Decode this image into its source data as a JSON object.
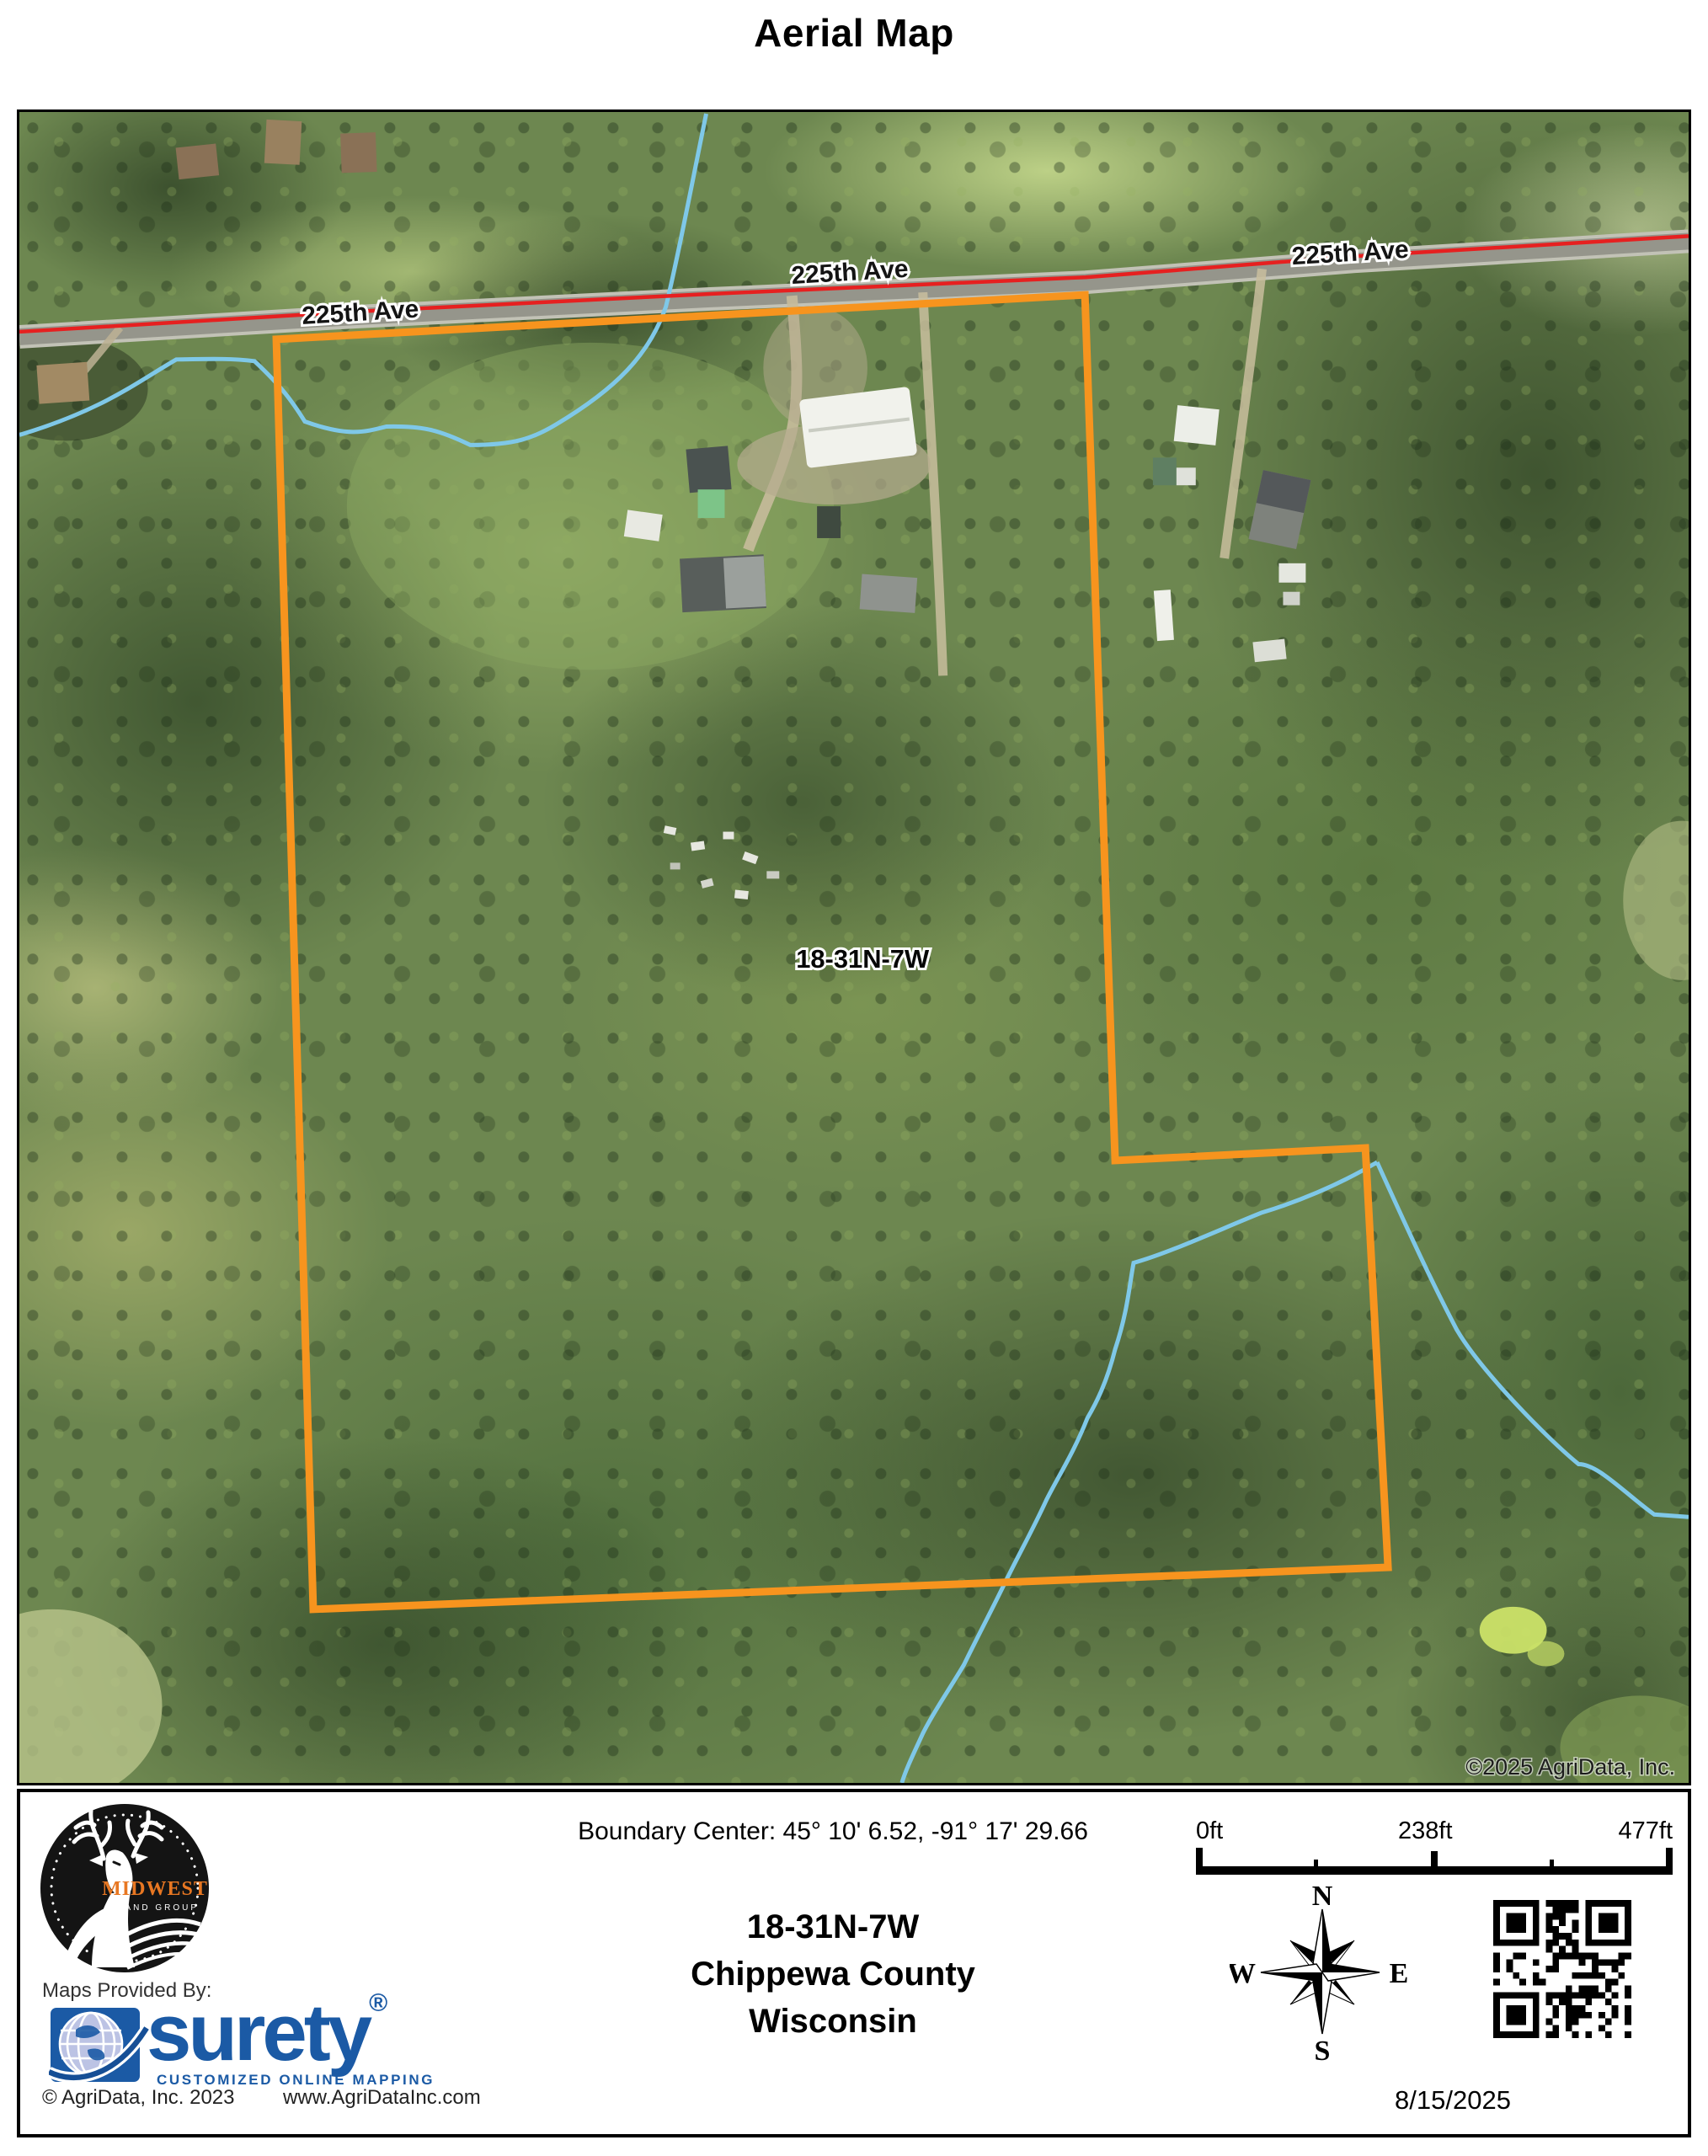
{
  "page": {
    "title": "Aerial Map"
  },
  "map": {
    "road_label": "225th Ave",
    "parcel_label": "18-31N-7W",
    "imagery_credit": "©2025 AgriData, Inc.",
    "colors": {
      "boundary": "#F7941E",
      "road_line": "#E62020",
      "water": "#7FC8E8"
    }
  },
  "footer": {
    "boundary_center": "Boundary Center: 45° 10' 6.52,  -91° 17' 29.66",
    "section": "18-31N-7W",
    "county": "Chippewa County",
    "state": "Wisconsin",
    "provider_label": "Maps Provided By:",
    "provider_name": "surety",
    "provider_reg": "®",
    "provider_tagline": "CUSTOMIZED ONLINE MAPPING",
    "provider_copyright": "© AgriData, Inc. 2023",
    "provider_website": "www.AgriDataInc.com",
    "date": "8/15/2025",
    "scale_bar": {
      "labels": [
        "0ft",
        "238ft",
        "477ft"
      ]
    },
    "compass": {
      "north": "N",
      "south": "S",
      "east": "E",
      "west": "W"
    },
    "logo": {
      "name": "MIDWEST",
      "sub": "LAND GROUP"
    },
    "colors": {
      "surety_blue": "#1B5AA5",
      "midwest_orange": "#E87722"
    }
  }
}
